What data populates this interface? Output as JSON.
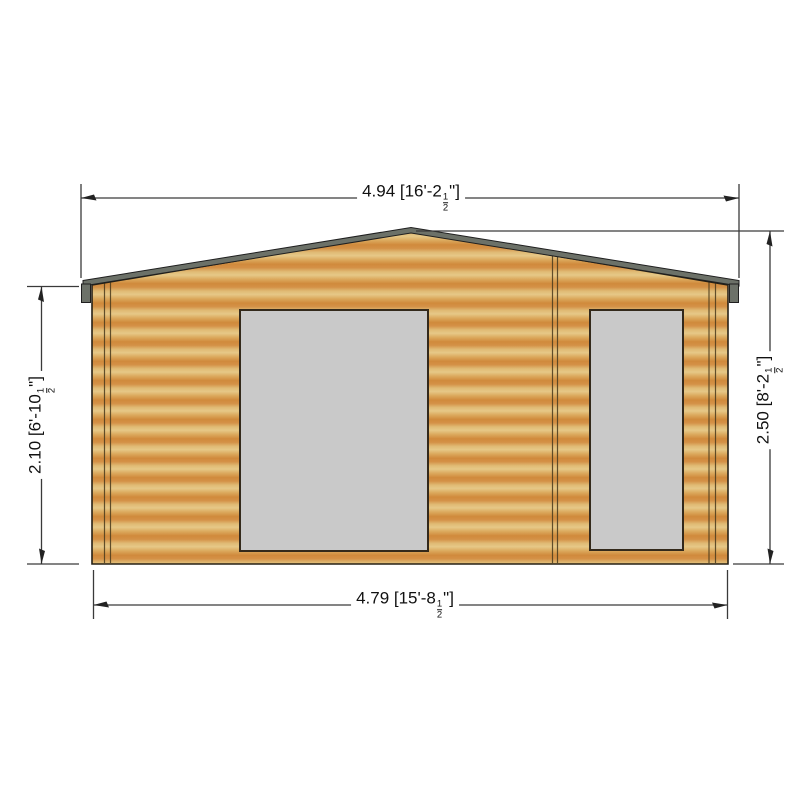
{
  "drawing": {
    "colors": {
      "wood_light": "#e6c887",
      "wood_mid": "#e0ba74",
      "wood_dark": "#d08a3c",
      "wood_dark2": "#d49147",
      "roof_gray": "#6c7168",
      "window_gray": "#c9c9c9",
      "outline": "#2b2416",
      "dim_line": "#3a3a3a",
      "dim_text": "#111111"
    },
    "dimensions": {
      "top": {
        "prefix": "4.94 [16'-2",
        "num": "1",
        "den": "2",
        "suffix": "\"]"
      },
      "bottom": {
        "prefix": "4.79 [15'-8",
        "num": "1",
        "den": "2",
        "suffix": "\"]"
      },
      "left": {
        "prefix": "2.10 [6'-10",
        "num": "1",
        "den": "2",
        "suffix": "\"]"
      },
      "right": {
        "prefix": "2.50 [8'-2",
        "num": "1",
        "den": "2",
        "suffix": "\"]"
      }
    }
  }
}
